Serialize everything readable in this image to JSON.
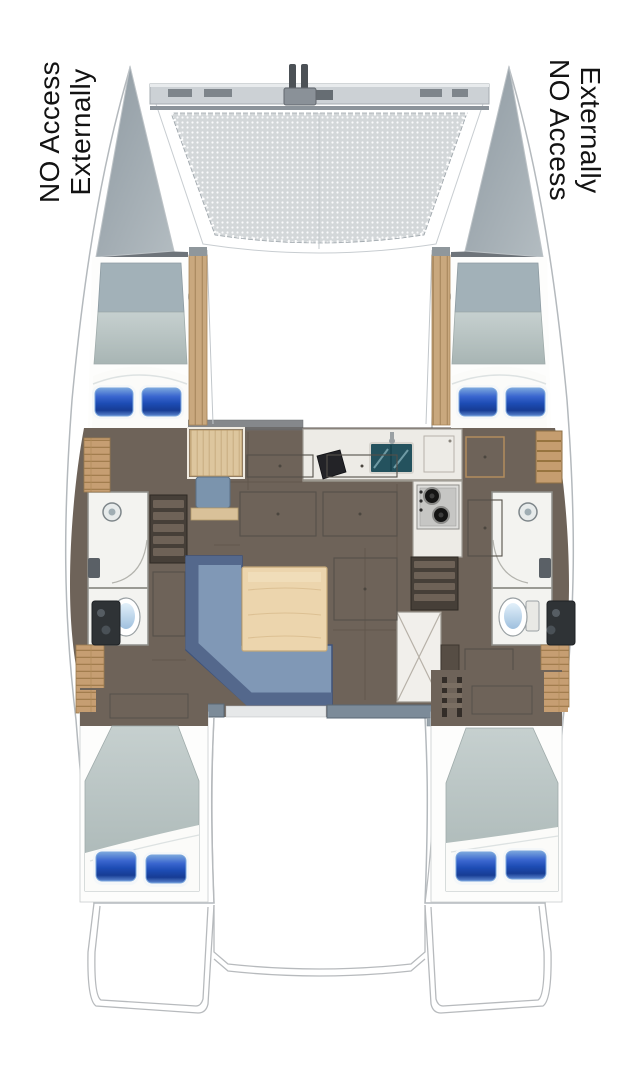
{
  "figure": {
    "kind": "catamaran yacht floor plan",
    "view": "top-down"
  },
  "labels": {
    "port_bow": {
      "line1": "NO Access",
      "line2": "Externally"
    },
    "starboard_bow": {
      "line1": "NO Access",
      "line2": "Externally"
    }
  },
  "colors": {
    "label_text": "#131313",
    "hull_bow": "#8f9aa2",
    "mesh": "#d3d7d9",
    "deck_wood": "#c69e72",
    "cabin_floor": "#6e6359",
    "counter": "#edebe6",
    "sink_teal": "#24525e",
    "sofa_seat": "#8098b6",
    "sofa_back": "#54688c",
    "table_wood": "#ecd5ad",
    "mattress": "#b6c1c0",
    "pillow_blue": "#1d4cb4",
    "pillow_edge": "#7aa6dd",
    "toilet_water": "#9fc0de",
    "bench_gray": "#7c8b99"
  }
}
